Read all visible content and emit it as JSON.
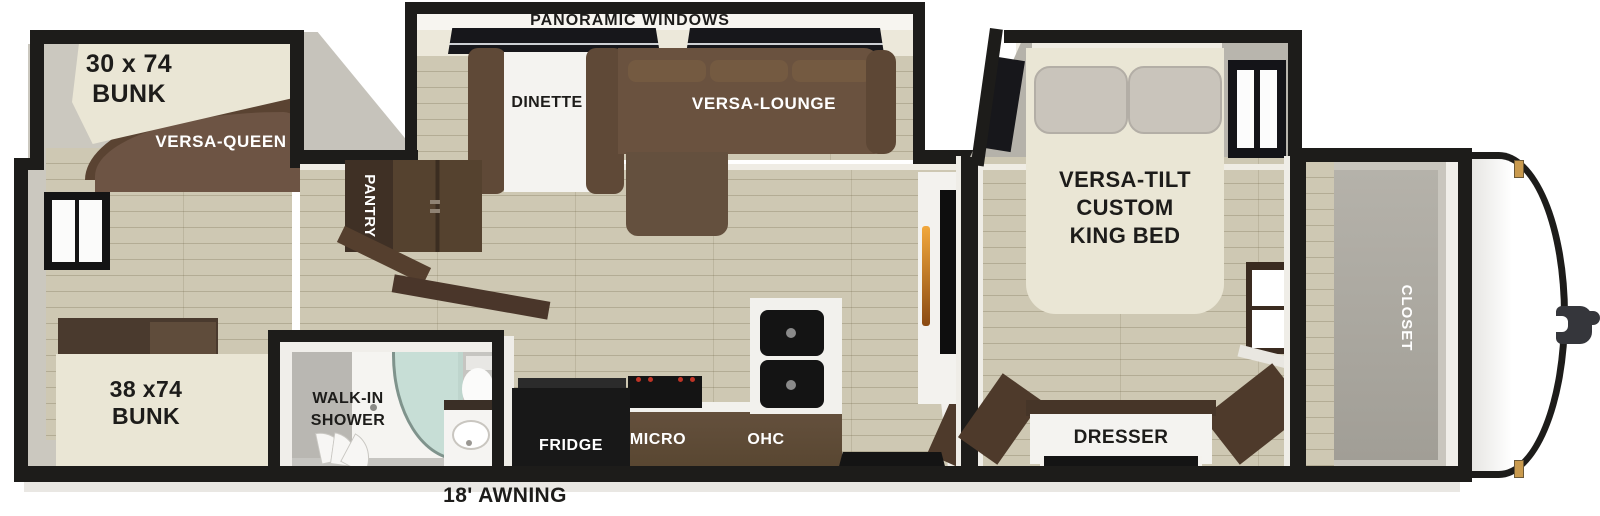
{
  "labels": {
    "panoramic_windows": "PANORAMIC WINDOWS",
    "bunk30_l1": "30 x 74",
    "bunk30_l2": "BUNK",
    "versa_queen": "VERSA-QUEEN",
    "bunk38_l1": "38 x74",
    "bunk38_l2": "BUNK",
    "dinette": "DINETTE",
    "versa_lounge": "VERSA-LOUNGE",
    "pantry": "PANTRY",
    "shower_l1": "WALK-IN",
    "shower_l2": "SHOWER",
    "fridge": "FRIDGE",
    "micro": "MICRO",
    "ohc": "OHC",
    "king_l1": "VERSA-TILT",
    "king_l2": "CUSTOM",
    "king_l3": "KING BED",
    "dresser": "DRESSER",
    "closet": "CLOSET",
    "awning": "18' AWNING"
  },
  "colors": {
    "wall": "#1d1c1a",
    "floor": "#cec8b3",
    "cream_bed": "#eae6d5",
    "sofa_brown": "#6a523f",
    "cabinet_brown": "#5c4937",
    "shower_glass": "#bcd8cf",
    "fireplace_glow": "#e8922a"
  }
}
